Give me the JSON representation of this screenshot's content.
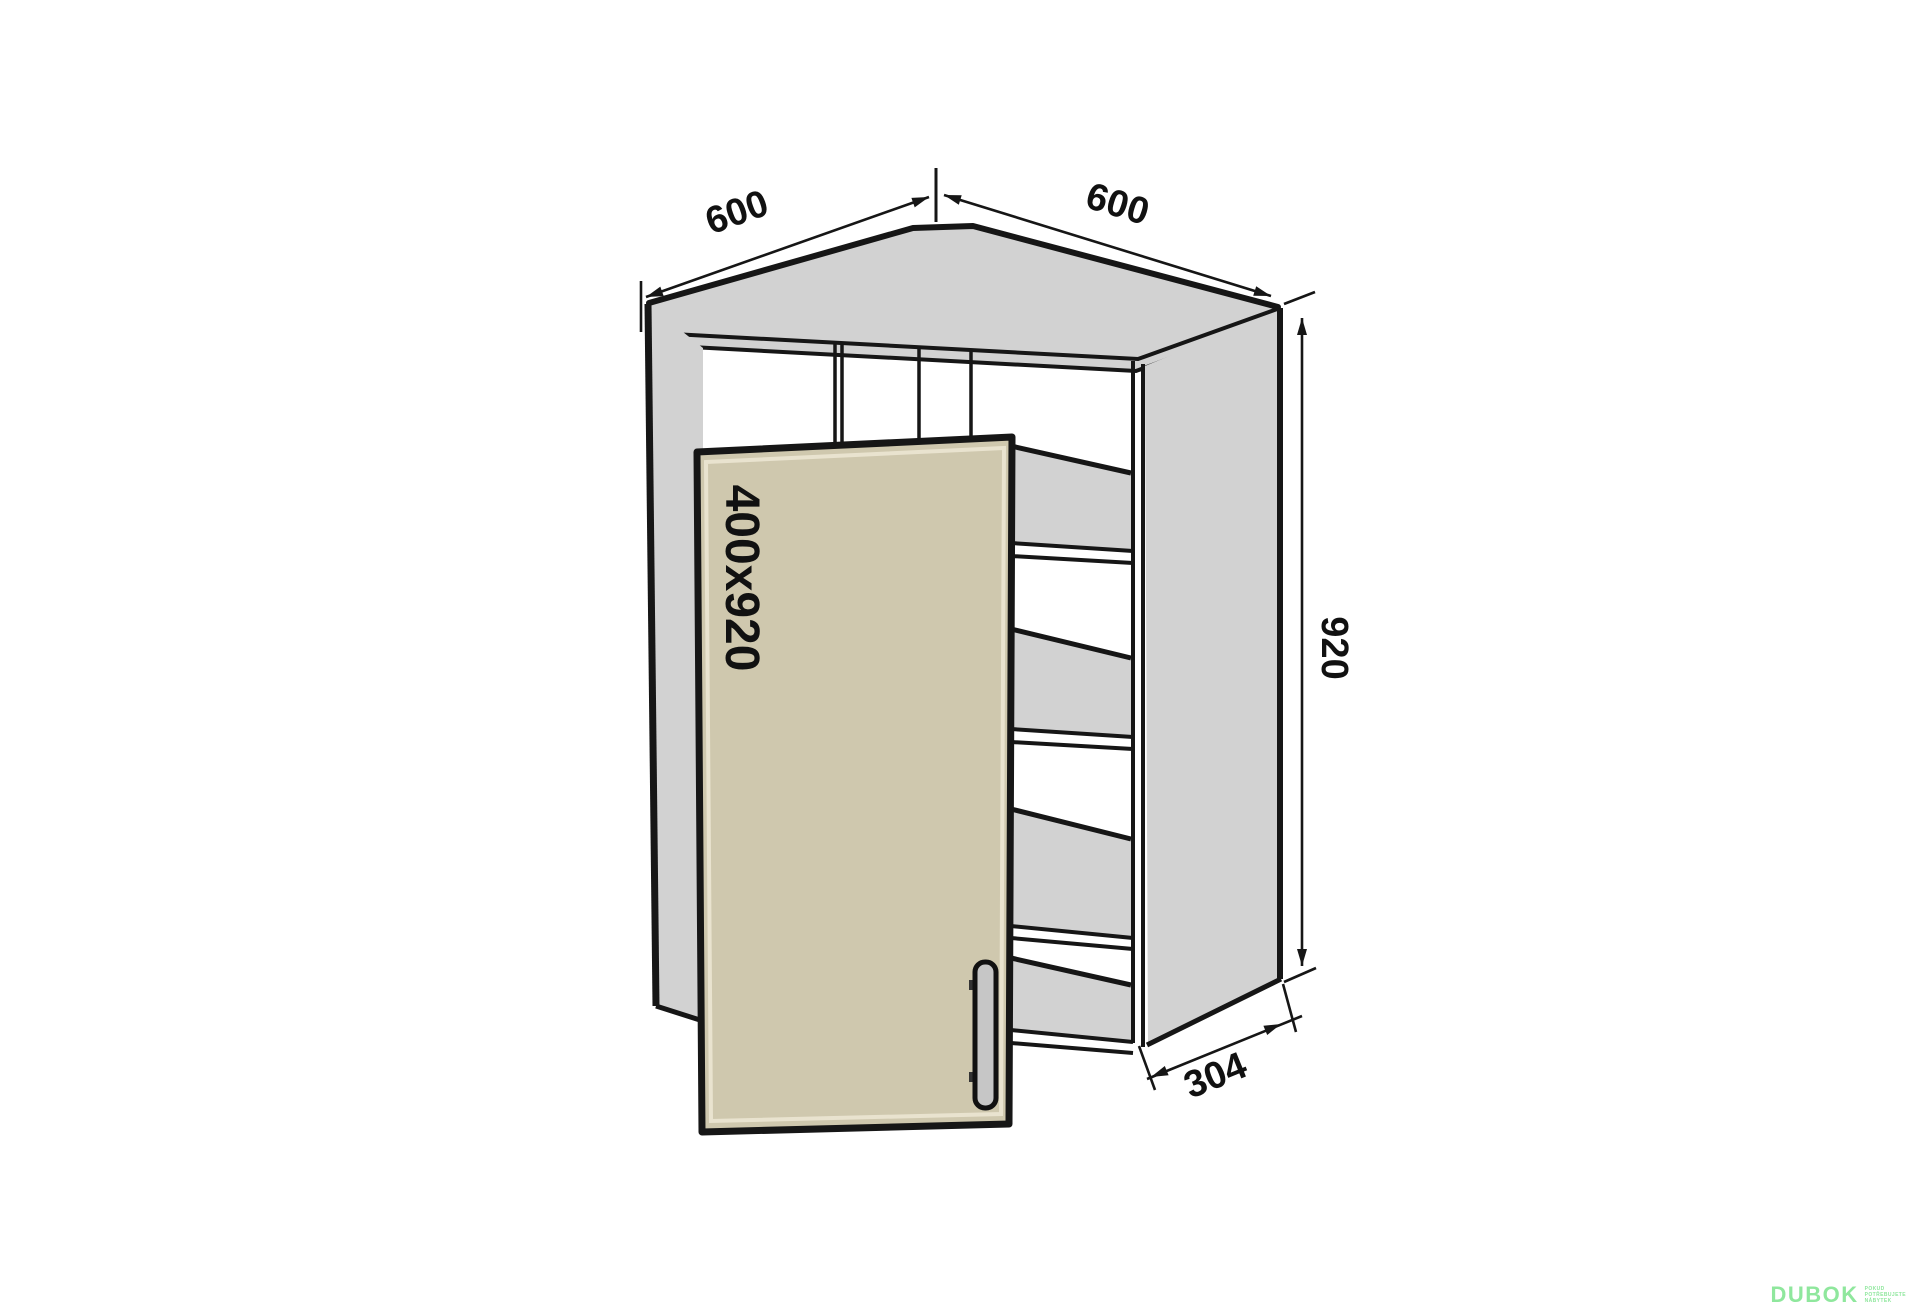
{
  "drawing": {
    "kind": "corner wall cabinet dimension drawing",
    "labels": {
      "width_left": "600",
      "width_right": "600",
      "height": "920",
      "side_depth": "304",
      "door_size": "400x920"
    }
  },
  "colors": {
    "background": "#ffffff",
    "line": "#161616",
    "panel_gray": "#d2d2d2",
    "door_beige": "#cfc8ae",
    "door_inner_edge": "#e9e3cf",
    "handle_fill": "#c6c6c6",
    "logo_green": "#8fe79d"
  },
  "logo": {
    "brand": "DUBOK",
    "tagline_lines": [
      "POKUD",
      "POTŘEBUJETE",
      "NÁBYTEK"
    ]
  }
}
